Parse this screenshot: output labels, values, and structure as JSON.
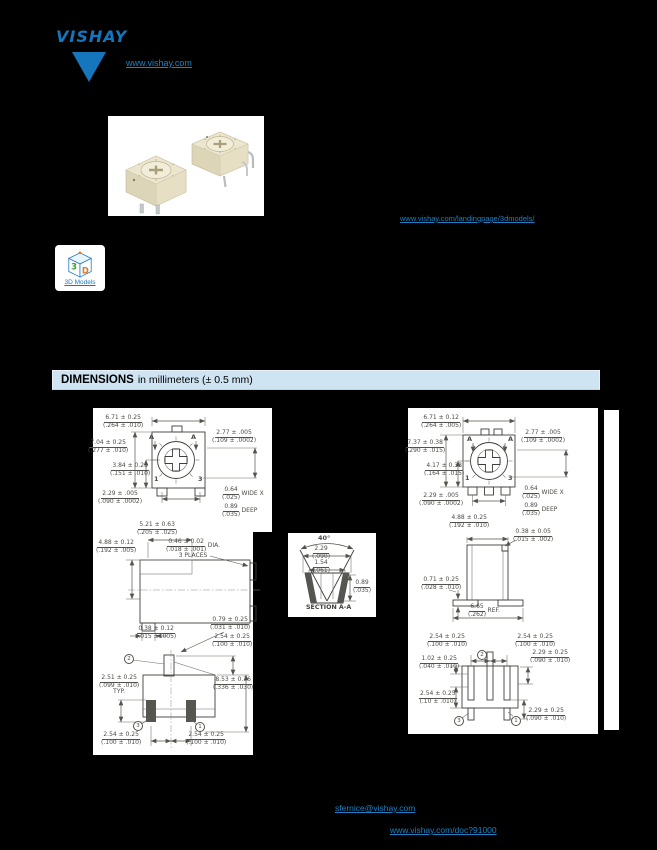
{
  "theme": {
    "accent_blue": "#1576be",
    "link_blue": "#1e81c4",
    "bar_bg": "#cfe4f2",
    "page_bg": "#000000",
    "line_gray": "#54544e"
  },
  "header": {
    "logo_text": "VISHAY",
    "site_link": "www.vishay.com"
  },
  "photo_links": {
    "models_link": "www.vishay.com/landingpage/3dmodels/"
  },
  "models_card": {
    "label": "3D Models",
    "cube_3": "3",
    "cube_d": "D"
  },
  "dim_bar": {
    "title": "DIMENSIONS",
    "subtitle": "in millimeters (± 0.5 mm)"
  },
  "views": {
    "left_top": {
      "w": {
        "mm": "6.71 ± 0.25",
        "in": "(.264 ± .010)"
      },
      "h": {
        "mm": "7.04 ± 0.25",
        "in": "(.277 ± .010)"
      },
      "rotor_off": {
        "mm": "3.84 ± 0.25",
        "in": "(.151 ± .010)"
      },
      "pin_pitch": {
        "mm": "2.29 ± .005",
        "in": "(.090 ± .0002)"
      },
      "slot_pos": {
        "mm": "2.77 ± .005",
        "in": "(.109 ± .0002)"
      },
      "slot_w": {
        "mm": "0.64",
        "in": "(.025)",
        "sfx": "WIDE X"
      },
      "slot_d": {
        "mm": "0.89",
        "in": "(.035)",
        "sfx": "DEEP"
      },
      "pin1": "1",
      "pin3": "3",
      "a_left": "A",
      "a_right": "A"
    },
    "left_side": {
      "top_w": {
        "mm": "5.21 ± 0.63",
        "in": "(.205 ± .025)"
      },
      "h": {
        "mm": "4.88 ± 0.12",
        "in": "(.192 ± .005)"
      },
      "pin_dia": {
        "mm": "0.46 ± 0.02",
        "in": "(.018 ± .001)",
        "sfx": "DIA.",
        "note": "3 PLACES"
      },
      "standoff": {
        "mm": "0.38 ± 0.12",
        "in": "(.015 ± .005)"
      }
    },
    "left_bottom": {
      "pin_off": {
        "mm": "0.79 ± 0.25",
        "in": "(.031 ± .010)"
      },
      "pin_h": {
        "mm": "2.54 ± 0.25",
        "in": "(.100 ± .010)"
      },
      "body": {
        "mm": "2.51 ± 0.25",
        "in": "(.099 ± .010)",
        "note": "TYP."
      },
      "total_h": {
        "mm": "8.53 ± 0.76",
        "in": "(.336 ± .030)"
      },
      "pitch_l": {
        "mm": "2.54 ± 0.25",
        "in": "(.100 ± .010)"
      },
      "pitch_r": {
        "mm": "2.54 ± 0.25",
        "in": "(.100 ± .010)"
      },
      "c1": "1",
      "c2": "2",
      "c3": "3"
    },
    "section": {
      "angle": "40°",
      "slot_w": {
        "mm": "2.29",
        "in": "(.090)"
      },
      "slot_iw": {
        "mm": "1.54",
        "in": "(.061)"
      },
      "depth": {
        "mm": "0.89",
        "in": "(.035)"
      },
      "caption": "SECTION A-A"
    },
    "right_top": {
      "w": {
        "mm": "6.71 ± 0.12",
        "in": "(.264 ± .005)"
      },
      "h": {
        "mm": "7.37 ± 0.38",
        "in": "(.290 ± .015)"
      },
      "rotor_off": {
        "mm": "4.17 ± 0.38",
        "in": "(.164 ± .015)"
      },
      "pin_pitch": {
        "mm": "2.29 ± .005",
        "in": "(.090 ± .0002)"
      },
      "slot_pos": {
        "mm": "2.77 ± .005",
        "in": "(.109 ± .0002)"
      },
      "slot_w": {
        "mm": "0.64",
        "in": "(.025)",
        "sfx": "WIDE X"
      },
      "slot_d": {
        "mm": "0.89",
        "in": "(.035)",
        "sfx": "DEEP"
      },
      "pin1": "1",
      "pin3": "3",
      "a_left": "A",
      "a_right": "A"
    },
    "right_side": {
      "top_w": {
        "mm": "4.88 ± 0.25",
        "in": "(.192 ± .010)"
      },
      "tab": {
        "mm": "0.38 ± 0.05",
        "in": "(.015 ± .002)"
      },
      "standoff": {
        "mm": "0.71 ± 0.25",
        "in": "(.028 ± .010)"
      },
      "foot": {
        "mm": "6.65",
        "in": "(.262)",
        "sfx": "REF."
      }
    },
    "right_bottom": {
      "pitch_l": {
        "mm": "2.54 ± 0.25",
        "in": "(.100 ± .010)"
      },
      "pitch_r": {
        "mm": "2.54 ± 0.25",
        "in": "(.100 ± .010)"
      },
      "pad_r": {
        "mm": "2.29 ± 0.25",
        "in": "(.090 ± .010)"
      },
      "pad_off": {
        "mm": "1.02 ± 0.25",
        "in": "(.040 ± .010)"
      },
      "pad_h": {
        "mm": "2.54 ± 0.25",
        "in": "(.10 ± .010)"
      },
      "pad_rb": {
        "mm": "2.29 ± 0.25",
        "in": "(.090 ± .010)"
      },
      "c1": "1",
      "c2": "2",
      "c3": "3"
    }
  },
  "footer": {
    "contact_email": "sfernice@vishay.com",
    "disclaimer_link": "www.vishay.com/doc?91000"
  }
}
